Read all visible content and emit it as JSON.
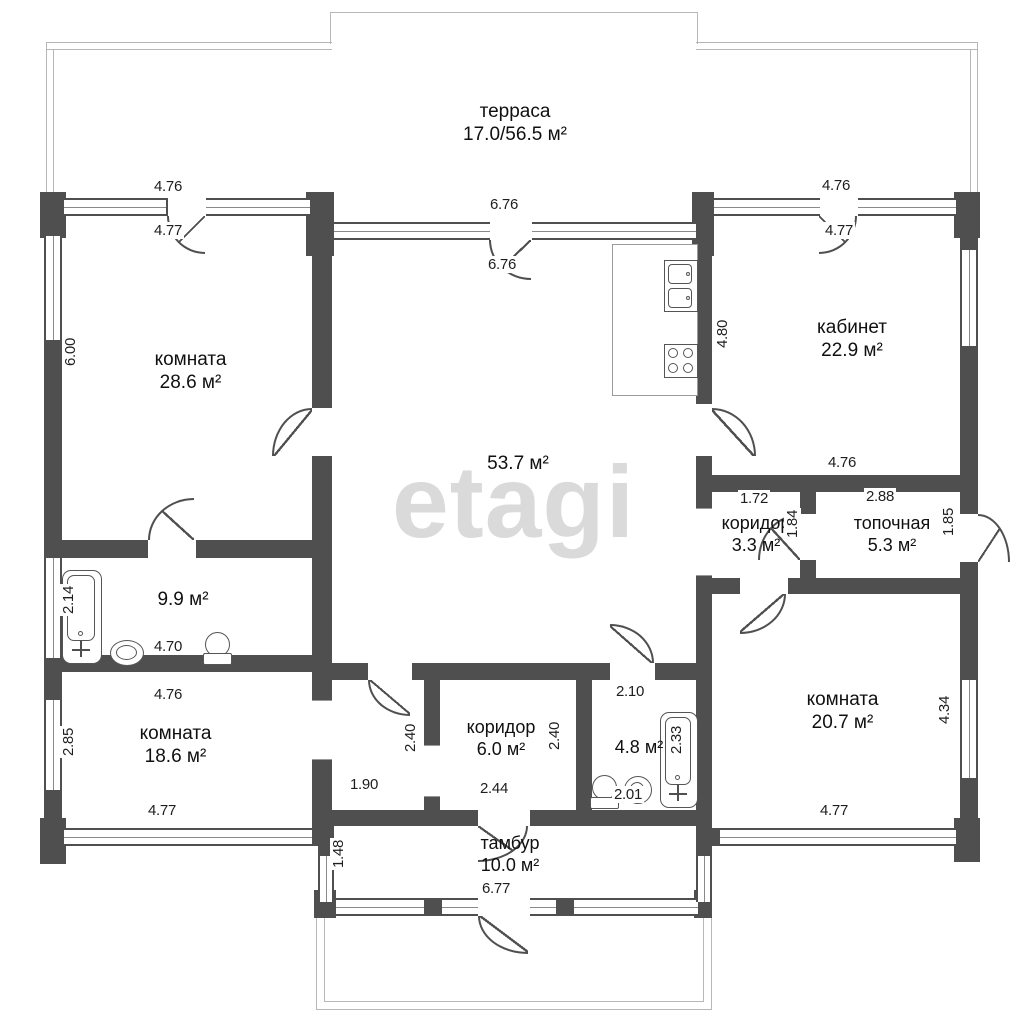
{
  "watermark": "etagi",
  "rooms": {
    "terrace": {
      "name": "терраса",
      "area": "17.0/56.5 м²"
    },
    "room_tl": {
      "name": "комната",
      "area": "28.6 м²"
    },
    "living": {
      "area": "53.7 м²"
    },
    "cabinet": {
      "name": "кабинет",
      "area": "22.9 м²"
    },
    "bath_top": {
      "area": "9.9 м²"
    },
    "room_bl": {
      "name": "комната",
      "area": "18.6 м²"
    },
    "hall_small": {
      "name": "коридор",
      "area": "3.3 м²"
    },
    "boiler": {
      "name": "топочная",
      "area": "5.3 м²"
    },
    "room_br": {
      "name": "комната",
      "area": "20.7 м²"
    },
    "corridor": {
      "name": "коридор",
      "area": "6.0 м²"
    },
    "bath_bottom": {
      "area": "4.8 м²"
    },
    "tambour": {
      "name": "тамбур",
      "area": "10.0 м²"
    }
  },
  "dimensions": {
    "top_left_out": "4.76",
    "top_left_in": "4.77",
    "top_center_out": "6.76",
    "top_center_in": "6.76",
    "top_right_out": "4.76",
    "top_right_in": "4.77",
    "left_room_height": "6.00",
    "bath_top_tub": "2.14",
    "bath_top_width": "4.70",
    "room_bl_top": "4.76",
    "room_bl_left": "2.85",
    "room_bl_bottom": "4.77",
    "hall_width": "1.90",
    "hall_height": "2.40",
    "corridor_height": "2.40",
    "corridor_width": "2.44",
    "bath_bottom_top": "2.10",
    "bath_bottom_tub": "2.33",
    "bath_bottom_width": "2.01",
    "tambour_left": "1.48",
    "tambour_bottom": "6.77",
    "cabinet_left": "4.80",
    "cabinet_bottom": "4.76",
    "hall_small_top": "1.72",
    "hall_small_right": "1.84",
    "boiler_top": "2.88",
    "boiler_right": "1.85",
    "room_br_right": "4.34",
    "room_br_bottom": "4.77"
  },
  "colors": {
    "wall": "#4f4f4f",
    "outline": "#b7b7b7",
    "text": "#1e1e1e",
    "watermark": "#dadada"
  }
}
